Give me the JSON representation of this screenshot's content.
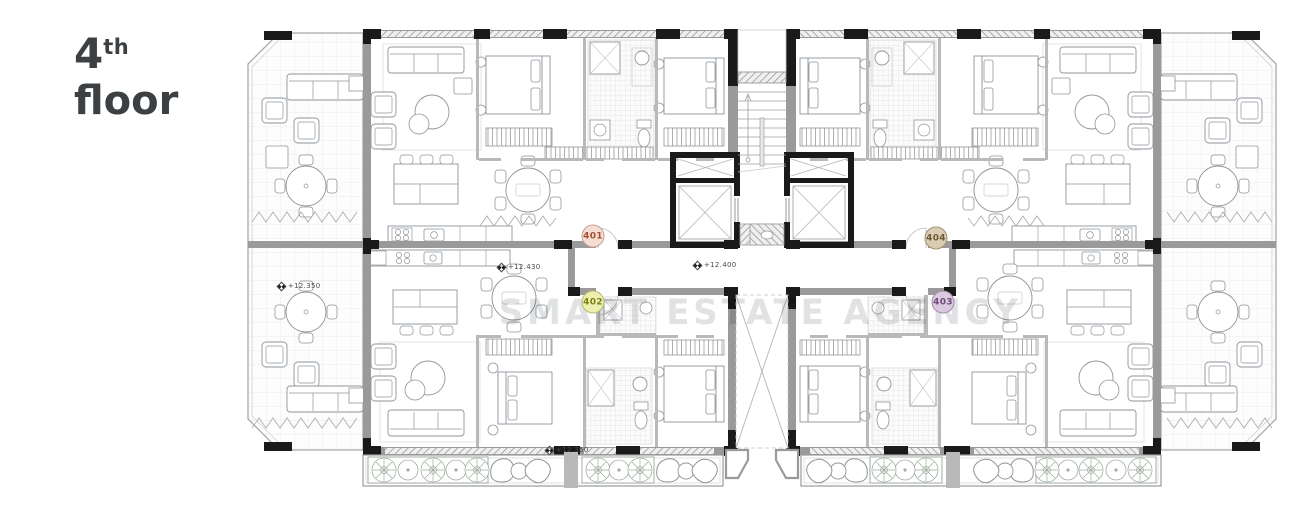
{
  "title": {
    "number": "4",
    "ordinal": "th",
    "word": "floor"
  },
  "watermark": {
    "text": "SMART ESTATE AGENCY"
  },
  "units": [
    {
      "label": "401",
      "bg": "#f6ddd2",
      "border": "#c5a092",
      "text": "#a34e30",
      "cx": 593,
      "cy": 236
    },
    {
      "label": "402",
      "bg": "#edefae",
      "border": "#b6ba70",
      "text": "#7c7f1d",
      "cx": 593,
      "cy": 302
    },
    {
      "label": "404",
      "bg": "#d8ccb2",
      "border": "#9f906c",
      "text": "#6b5a33",
      "cx": 936,
      "cy": 238
    },
    {
      "label": "403",
      "bg": "#dbc9df",
      "border": "#a78aae",
      "text": "#6f487c",
      "cx": 943,
      "cy": 302
    }
  ],
  "levels": [
    {
      "text": "+12.350",
      "x": 278,
      "y": 286
    },
    {
      "text": "+12.430",
      "x": 498,
      "y": 267
    },
    {
      "text": "+12.400",
      "x": 694,
      "y": 265
    },
    {
      "text": "+12.350",
      "x": 546,
      "y": 450
    }
  ],
  "plan": {
    "wall_color": "#9a9a9a",
    "structure_color": "#1a1a1a",
    "line_color": "#8f959b",
    "floor_color": "#ffffff"
  }
}
